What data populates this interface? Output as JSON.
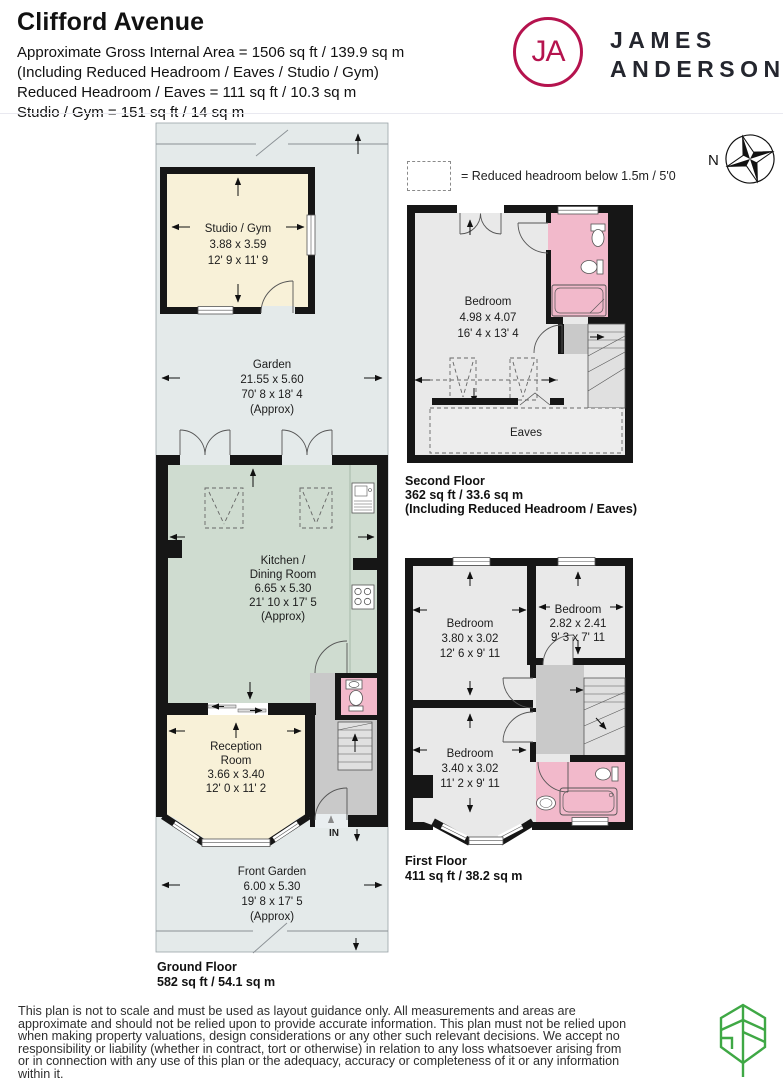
{
  "header": {
    "title": "Clifford Avenue",
    "area_lines": [
      "Approximate Gross Internal Area = 1506 sq ft / 139.9 sq m",
      "(Including Reduced Headroom / Eaves / Studio / Gym)",
      "Reduced Headroom / Eaves = 111 sq ft / 10.3 sq m",
      "Studio / Gym = 151 sq ft / 14 sq m"
    ],
    "brand": {
      "monogram": "JA",
      "name_lines": [
        "JAMES",
        "ANDERSON"
      ]
    }
  },
  "legend": {
    "text": "= Reduced headroom below 1.5m / 5'0"
  },
  "compass": {
    "north_label": "N"
  },
  "floors": {
    "ground": {
      "label": "Ground Floor",
      "area": "582 sq ft / 54.1 sq m",
      "entrance": "IN",
      "rooms": {
        "studio": [
          "Studio / Gym",
          "3.88 x 3.59",
          "12' 9 x 11' 9"
        ],
        "garden": [
          "Garden",
          "21.55 x 5.60",
          "70' 8 x 18' 4",
          "(Approx)"
        ],
        "kitchen": [
          "Kitchen /",
          "Dining Room",
          "6.65 x 5.30",
          "21' 10 x 17' 5",
          "(Approx)"
        ],
        "reception": [
          "Reception",
          "Room",
          "3.66 x 3.40",
          "12' 0 x 11' 2"
        ],
        "front_garden": [
          "Front Garden",
          "6.00 x 5.30",
          "19' 8 x 17' 5",
          "(Approx)"
        ]
      }
    },
    "second": {
      "label": "Second Floor",
      "area": "362 sq ft / 33.6 sq m",
      "note": "(Including Reduced Headroom / Eaves)",
      "rooms": {
        "bedroom": [
          "Bedroom",
          "4.98 x 4.07",
          "16' 4 x 13' 4"
        ],
        "eaves": "Eaves"
      }
    },
    "first": {
      "label": "First Floor",
      "area": "411 sq ft / 38.2 sq m",
      "rooms": {
        "bedroom_rear": [
          "Bedroom",
          "3.80 x 3.02",
          "12' 6 x 9' 11"
        ],
        "bedroom_small": [
          "Bedroom",
          "2.82 x 2.41",
          "9' 3 x 7' 11"
        ],
        "bedroom_front": [
          "Bedroom",
          "3.40 x 3.02",
          "11' 2 x 9' 11"
        ]
      }
    }
  },
  "footer": {
    "disclaimer": "This plan is not to scale and must be used as layout guidance only. All measurements and areas are approximate and should not be relied upon to provide accurate information. This plan must not be relied upon when making property valuations, design considerations or any other such relevant decisions. We accept no responsibility or liability (whether in contract, tort or otherwise) in relation to any loss whatsoever arising from or in connection with any use of this plan or the adequacy, accuracy or completeness of it or any information within it."
  },
  "colors": {
    "brand_accent": "#b5134e",
    "leaf_green": "#3fa845",
    "room_cream": "#f8f1d8",
    "room_sage": "#cfdcd0",
    "garden_grey": "#e4eaea",
    "bathroom_pink": "#f2b9cb",
    "room_grey": "#e9e9e9",
    "hall_grey": "#c9c9c9"
  }
}
